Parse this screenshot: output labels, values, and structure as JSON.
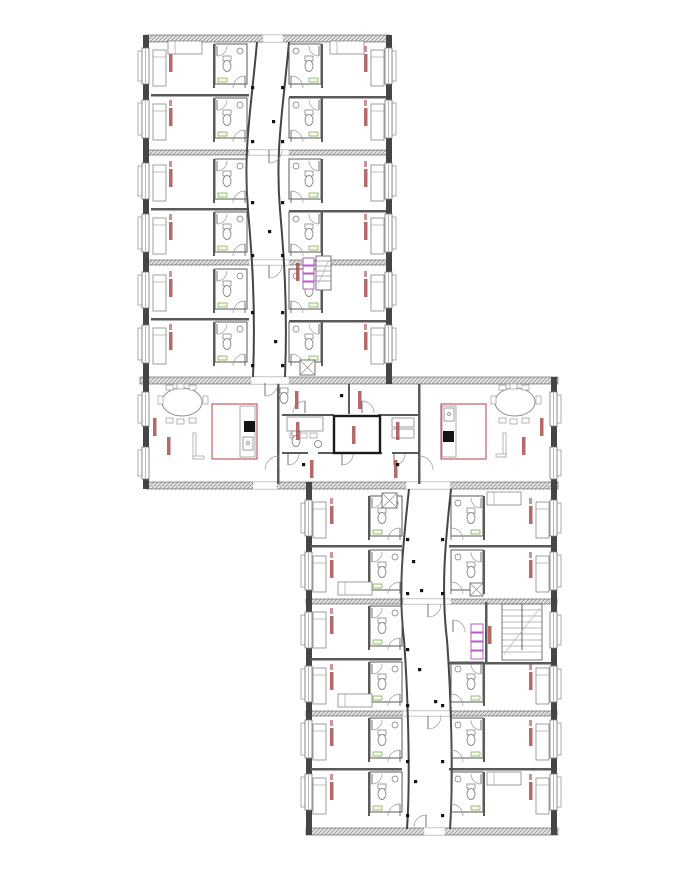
{
  "meta": {
    "title": ""
  },
  "canvas": {
    "w": 674,
    "h": 881,
    "bg": "#ffffff"
  },
  "colors": {
    "wall": "#454545",
    "thin": "#5a5a5a",
    "line": "#8c8c8c",
    "arc": "#9a9a9a",
    "hatch_line": "#8a8a8a",
    "hatch_bg": "#e3e3e3",
    "tag_red": "#a84f4f",
    "kitchen_red": "#b04040",
    "green": "#86b05e",
    "purple": "#b45cc4",
    "black": "#141414"
  },
  "walls_hatched": [
    [
      145,
      35,
      245,
      7
    ],
    [
      140,
      377,
      418,
      7
    ],
    [
      146,
      482,
      412,
      7
    ],
    [
      306,
      828,
      252,
      7
    ],
    [
      145,
      150,
      245,
      5
    ],
    [
      145,
      260,
      245,
      5
    ],
    [
      306,
      599,
      251,
      5
    ],
    [
      306,
      711,
      251,
      5
    ]
  ],
  "wall_openings": [
    [
      263,
      35,
      20,
      7
    ],
    [
      251,
      377,
      38,
      7
    ],
    [
      253,
      482,
      24,
      7
    ],
    [
      406,
      482,
      44,
      7
    ],
    [
      424,
      828,
      21,
      7
    ],
    [
      249,
      150,
      40,
      5
    ],
    [
      249,
      260,
      40,
      5
    ],
    [
      403,
      599,
      48,
      5
    ],
    [
      403,
      711,
      48,
      5
    ]
  ],
  "walls_solid": [
    [
      143,
      35,
      6,
      454
    ],
    [
      386,
      35,
      6,
      349
    ],
    [
      551,
      377,
      6,
      458
    ],
    [
      306,
      482,
      6,
      353
    ]
  ],
  "walls_thin": [
    [
      151,
      94,
      98,
      2.5
    ],
    [
      289,
      96,
      97,
      2.5
    ],
    [
      151,
      208,
      98,
      2.5
    ],
    [
      289,
      210,
      97,
      2.5
    ],
    [
      151,
      318,
      98,
      2.5
    ],
    [
      289,
      320,
      97,
      2.5
    ],
    [
      311,
      545,
      91,
      2.5
    ],
    [
      449,
      545,
      102,
      2.5
    ],
    [
      311,
      658,
      91,
      2.5
    ],
    [
      449,
      662,
      102,
      2.5
    ],
    [
      311,
      768,
      91,
      2.5
    ],
    [
      449,
      768,
      102,
      2.5
    ],
    [
      485,
      602,
      2.5,
      62
    ],
    [
      277,
      384,
      2.5,
      100
    ],
    [
      418,
      384,
      2.5,
      100
    ],
    [
      348,
      384,
      2,
      30
    ],
    [
      282,
      414,
      52,
      2
    ],
    [
      378,
      414,
      42,
      2
    ],
    [
      282,
      452,
      26,
      2
    ],
    [
      318,
      452,
      64,
      2
    ],
    [
      392,
      452,
      28,
      2
    ]
  ],
  "corridor_walls": [
    "M257,42 C251,110 243,150 248,210 C251,245 256,300 253,377",
    "M289,42 C283,110 275,150 280,210 C283,245 288,300 285,377",
    "M409,489 C403,545 398,590 404,640 C407,680 411,770 407,829",
    "M451,489 C445,545 441,590 447,640 C450,680 454,770 450,829"
  ],
  "modules": {
    "UL": {
      "bedX": 153,
      "tagX": 169,
      "bathX": 215,
      "divX": 213,
      "corrX": 247,
      "mirror": false
    },
    "UR": {
      "bedX": 371,
      "tagX": 364,
      "bathX": 289,
      "divX": 321,
      "corrX": 289,
      "mirror": true
    },
    "LL": {
      "bedX": 313,
      "tagX": 330,
      "bathX": 370,
      "divX": 368,
      "corrX": 402,
      "mirror": false
    },
    "LR": {
      "bedX": 536,
      "tagX": 529,
      "bathX": 451,
      "divX": 483,
      "corrX": 449,
      "mirror": true
    }
  },
  "apartments": [
    {
      "m": "UL",
      "y": 42
    },
    {
      "m": "UL",
      "y": 96
    },
    {
      "m": "UL",
      "y": 157
    },
    {
      "m": "UL",
      "y": 210
    },
    {
      "m": "UL",
      "y": 267
    },
    {
      "m": "UL",
      "y": 320
    },
    {
      "m": "UR",
      "y": 42
    },
    {
      "m": "UR",
      "y": 96
    },
    {
      "m": "UR",
      "y": 157
    },
    {
      "m": "UR",
      "y": 210
    },
    {
      "m": "UR",
      "y": 267
    },
    {
      "m": "UR",
      "y": 320
    },
    {
      "m": "LL",
      "y": 494
    },
    {
      "m": "LL",
      "y": 548
    },
    {
      "m": "LL",
      "y": 604
    },
    {
      "m": "LL",
      "y": 660
    },
    {
      "m": "LL",
      "y": 716
    },
    {
      "m": "LL",
      "y": 770
    },
    {
      "m": "LR",
      "y": 494
    },
    {
      "m": "LR",
      "y": 548
    },
    {
      "m": "LR",
      "y": 660
    },
    {
      "m": "LR",
      "y": 716
    },
    {
      "m": "LR",
      "y": 770
    }
  ],
  "windows": [
    {
      "side": "l",
      "x": 142,
      "y": 48,
      "h": 36
    },
    {
      "side": "l",
      "x": 142,
      "y": 100,
      "h": 38
    },
    {
      "side": "l",
      "x": 142,
      "y": 163,
      "h": 36
    },
    {
      "side": "l",
      "x": 142,
      "y": 214,
      "h": 38
    },
    {
      "side": "l",
      "x": 142,
      "y": 272,
      "h": 36
    },
    {
      "side": "l",
      "x": 142,
      "y": 325,
      "h": 38
    },
    {
      "side": "l",
      "x": 142,
      "y": 392,
      "h": 34
    },
    {
      "side": "l",
      "x": 142,
      "y": 447,
      "h": 32
    },
    {
      "side": "r",
      "x": 385,
      "y": 48,
      "h": 36
    },
    {
      "side": "r",
      "x": 385,
      "y": 100,
      "h": 38
    },
    {
      "side": "r",
      "x": 385,
      "y": 163,
      "h": 36
    },
    {
      "side": "r",
      "x": 385,
      "y": 214,
      "h": 38
    },
    {
      "side": "r",
      "x": 385,
      "y": 272,
      "h": 36
    },
    {
      "side": "r",
      "x": 385,
      "y": 325,
      "h": 38
    },
    {
      "side": "r",
      "x": 550,
      "y": 392,
      "h": 34
    },
    {
      "side": "r",
      "x": 550,
      "y": 447,
      "h": 32
    },
    {
      "side": "r",
      "x": 550,
      "y": 500,
      "h": 36
    },
    {
      "side": "r",
      "x": 550,
      "y": 552,
      "h": 38
    },
    {
      "side": "r",
      "x": 550,
      "y": 612,
      "h": 36
    },
    {
      "side": "r",
      "x": 550,
      "y": 666,
      "h": 36
    },
    {
      "side": "r",
      "x": 550,
      "y": 720,
      "h": 38
    },
    {
      "side": "r",
      "x": 550,
      "y": 774,
      "h": 36
    },
    {
      "side": "l",
      "x": 305,
      "y": 500,
      "h": 36
    },
    {
      "side": "l",
      "x": 305,
      "y": 552,
      "h": 38
    },
    {
      "side": "l",
      "x": 305,
      "y": 612,
      "h": 36
    },
    {
      "side": "l",
      "x": 305,
      "y": 666,
      "h": 36
    },
    {
      "side": "l",
      "x": 305,
      "y": 720,
      "h": 38
    },
    {
      "side": "l",
      "x": 305,
      "y": 774,
      "h": 36
    }
  ],
  "beds_horizontal": [
    [
      168,
      41
    ],
    [
      330,
      41
    ],
    [
      338,
      582
    ],
    [
      487,
      492
    ],
    [
      338,
      694
    ],
    [
      487,
      772
    ]
  ],
  "kitchens": [
    {
      "rect": [
        212,
        404,
        45,
        55
      ],
      "col": [
        240,
        406,
        15,
        51
      ],
      "stove": [
        244,
        421,
        11,
        11
      ],
      "sink": [
        243,
        437,
        10,
        13
      ],
      "tap": [
        248,
        443
      ]
    },
    {
      "rect": [
        441,
        404,
        45,
        55
      ],
      "col": [
        442,
        406,
        14,
        51
      ],
      "stove": [
        443,
        431,
        11,
        11
      ],
      "sink": [
        444,
        408,
        10,
        13
      ],
      "tap": [
        449,
        414
      ]
    }
  ],
  "tables": [
    {
      "cx": 182,
      "cy": 402,
      "rx": 20,
      "ry": 14,
      "chairs": [
        [
          166,
          385,
          7,
          5
        ],
        [
          177,
          384,
          7,
          5
        ],
        [
          189,
          385,
          7,
          5
        ],
        [
          166,
          418,
          7,
          5
        ],
        [
          177,
          419,
          7,
          5
        ],
        [
          189,
          418,
          7,
          5
        ],
        [
          158,
          396,
          5,
          8
        ],
        [
          203,
          396,
          5,
          8
        ]
      ]
    },
    {
      "cx": 515,
      "cy": 402,
      "rx": 20,
      "ry": 14,
      "chairs": [
        [
          499,
          385,
          7,
          5
        ],
        [
          510,
          384,
          7,
          5
        ],
        [
          522,
          385,
          7,
          5
        ],
        [
          499,
          418,
          7,
          5
        ],
        [
          510,
          419,
          7,
          5
        ],
        [
          522,
          418,
          7,
          5
        ],
        [
          491,
          396,
          5,
          8
        ],
        [
          536,
          396,
          5,
          8
        ]
      ]
    }
  ],
  "sofa_marks": [
    [
      193,
      433,
      3,
      26
    ],
    [
      193,
      456,
      11,
      3
    ],
    [
      503,
      433,
      3,
      24
    ],
    [
      496,
      454,
      10,
      3
    ]
  ],
  "lift": {
    "rect": [
      334,
      416,
      46,
      37
    ]
  },
  "desk": {
    "rect": [
      287,
      417,
      36,
      14
    ],
    "chairs": [
      [
        290,
        433,
        7,
        5
      ],
      [
        300,
        433,
        7,
        5
      ],
      [
        310,
        433,
        7,
        5
      ]
    ]
  },
  "shelves": [
    [
      392,
      418,
      22,
      9
    ],
    [
      392,
      429,
      22,
      9
    ]
  ],
  "toilets_extra": [
    [
      284,
      398
    ],
    [
      296,
      441
    ]
  ],
  "sinks_extra": [
    [
      318,
      444
    ]
  ],
  "shower_boxes": [
    [
      300,
      360,
      15,
      15
    ],
    [
      382,
      493,
      15,
      15
    ],
    [
      470,
      583,
      13,
      13
    ]
  ],
  "lockers": [
    {
      "x": 303,
      "y": 258,
      "w": 11,
      "h": 7,
      "n": 4
    },
    {
      "x": 471,
      "y": 624,
      "w": 12,
      "h": 8,
      "n": 4
    }
  ],
  "stairs": [
    {
      "rect": [
        316,
        256,
        15,
        34
      ],
      "step": 5
    },
    {
      "rect": [
        502,
        604,
        40,
        56
      ],
      "step": 6,
      "divX": 522
    }
  ],
  "door_arcs": [
    {
      "x": 265,
      "y": 383,
      "r": 13,
      "q": "br"
    },
    {
      "x": 305,
      "y": 413,
      "r": 12,
      "q": "tl"
    },
    {
      "x": 362,
      "y": 413,
      "r": 12,
      "q": "tr"
    },
    {
      "x": 288,
      "y": 454,
      "r": 11,
      "q": "br"
    },
    {
      "x": 342,
      "y": 454,
      "r": 11,
      "q": "br"
    },
    {
      "x": 394,
      "y": 454,
      "r": 11,
      "q": "br"
    },
    {
      "x": 279,
      "y": 470,
      "r": 14,
      "q": "tl"
    },
    {
      "x": 419,
      "y": 470,
      "r": 14,
      "q": "tr"
    },
    {
      "x": 453,
      "y": 632,
      "r": 12,
      "q": "tr"
    },
    {
      "x": 426,
      "y": 827,
      "r": 12,
      "q": "tl"
    },
    {
      "x": 269,
      "y": 150,
      "r": 13,
      "q": "br"
    },
    {
      "x": 269,
      "y": 265,
      "r": 13,
      "q": "br"
    },
    {
      "x": 428,
      "y": 604,
      "r": 13,
      "q": "br"
    },
    {
      "x": 428,
      "y": 716,
      "r": 13,
      "q": "br"
    }
  ],
  "room_tags": [
    [
      167,
      437
    ],
    [
      153,
      418
    ],
    [
      522,
      437
    ],
    [
      540,
      418
    ],
    [
      295,
      391
    ],
    [
      358,
      391
    ],
    [
      296,
      422
    ],
    [
      352,
      426
    ],
    [
      396,
      422
    ],
    [
      310,
      460
    ],
    [
      394,
      460
    ],
    [
      296,
      263
    ],
    [
      488,
      626
    ]
  ],
  "door_dots": [
    [
      340,
      394
    ],
    [
      302,
      463
    ],
    [
      396,
      463
    ],
    [
      420,
      589
    ],
    [
      434,
      700
    ],
    [
      272,
      120
    ],
    [
      268,
      230
    ],
    [
      274,
      340
    ],
    [
      412,
      560
    ],
    [
      418,
      668
    ],
    [
      414,
      780
    ]
  ]
}
